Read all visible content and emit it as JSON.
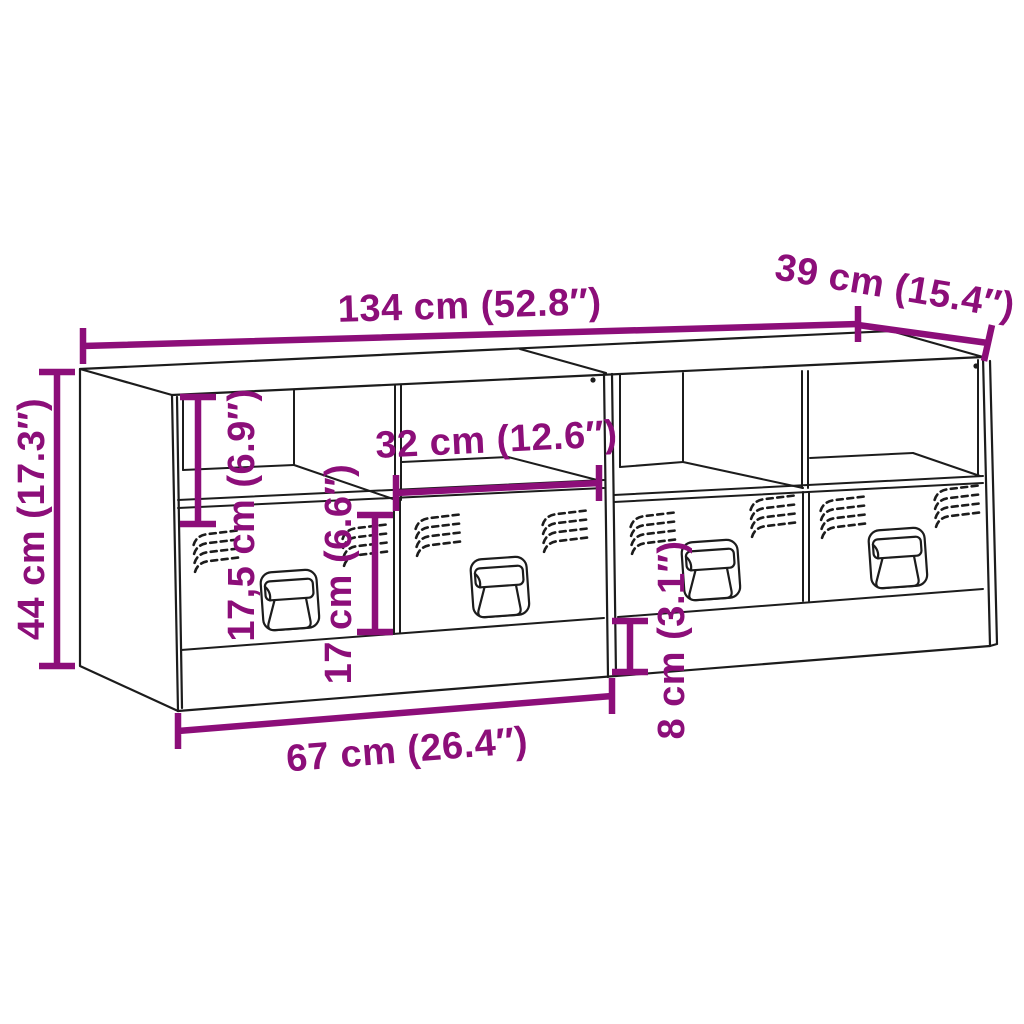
{
  "diagram": {
    "subject": "two-unit TV cabinet line drawing with open shelves, ventilated drawer fronts and fold-down handles",
    "colors": {
      "background": "#ffffff",
      "outline": "#1c1c1c",
      "dimension": "#8C0E79"
    },
    "dimensions": [
      {
        "id": "total-width",
        "label": "134 cm (52.8″)"
      },
      {
        "id": "depth",
        "label": "39 cm (15.4″)"
      },
      {
        "id": "total-height",
        "label": "44 cm (17.3″)"
      },
      {
        "id": "shelf-height",
        "label": "17,5 cm (6.9″)"
      },
      {
        "id": "shelf-width",
        "label": "32 cm (12.6″)"
      },
      {
        "id": "drawer-height",
        "label": "17 cm (6.6″)"
      },
      {
        "id": "unit-width",
        "label": "67 cm (26.4″)"
      },
      {
        "id": "base-height",
        "label": "8 cm (3.1″)"
      }
    ]
  }
}
